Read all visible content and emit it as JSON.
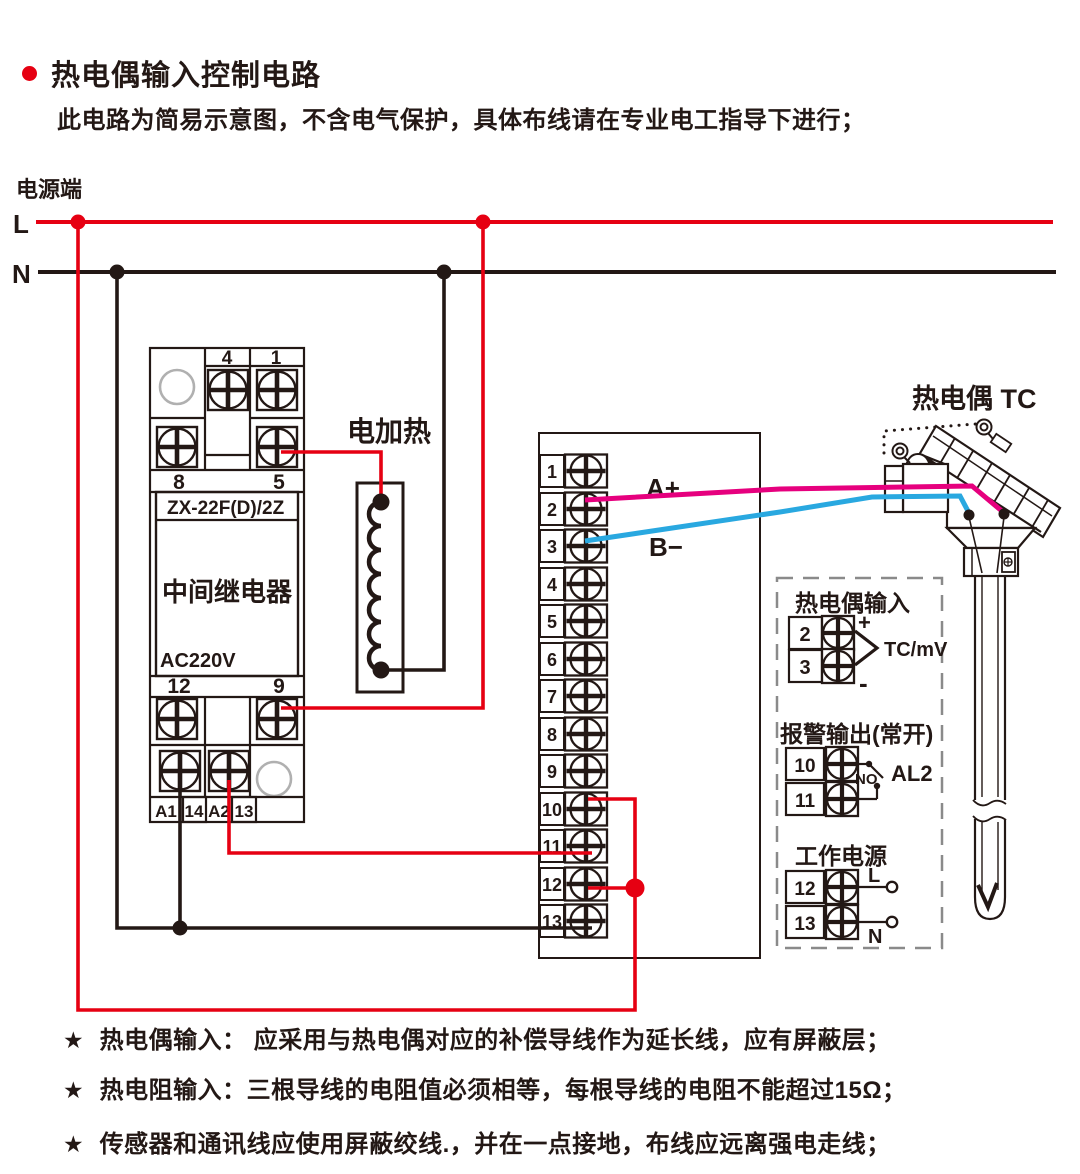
{
  "title": "热电偶输入控制电路",
  "subtitle": "此电路为简易示意图，不含电气保护，具体布线请在专业电工指导下进行；",
  "power": {
    "label": "电源端",
    "l": "L",
    "n": "N"
  },
  "relay": {
    "t4": "4",
    "t1": "1",
    "t8": "8",
    "t5": "5",
    "model": "ZX-22F(D)/2Z",
    "name": "中间继电器",
    "voltage": "AC220V",
    "t12": "12",
    "t9": "9",
    "a1": "A1",
    "t14": "14",
    "a2": "A2",
    "t13": "13"
  },
  "heater": {
    "label": "电加热"
  },
  "instrument": {
    "terminals": [
      "1",
      "2",
      "3",
      "4",
      "5",
      "6",
      "7",
      "8",
      "9",
      "10",
      "11",
      "12",
      "13"
    ],
    "wire_a": "A+",
    "wire_b": "B−"
  },
  "tc": {
    "label": "热电偶 TC"
  },
  "panel": {
    "tc_input": {
      "title": "热电偶输入",
      "t2": "2",
      "t3": "3",
      "plus": "+",
      "minus": "-",
      "signal": "TC/mV"
    },
    "alarm": {
      "title": "报警输出(常开)",
      "t10": "10",
      "t11": "11",
      "contact": "NO",
      "name": "AL2"
    },
    "supply": {
      "title": "工作电源",
      "t12": "12",
      "t13": "13",
      "l": "L",
      "n": "N"
    }
  },
  "note_marker": "★",
  "notes": [
    "热电偶输入： 应采用与热电偶对应的补偿导线作为延长线，应有屏蔽层；",
    "热电阻输入：三根导线的电阻值必须相等，每根导线的电阻不能超过15Ω；",
    "传感器和通讯线应使用屏蔽绞线.，并在一点接地，布线应远离强电走线；"
  ],
  "colors": {
    "live": "#e60012",
    "neutral": "#231815",
    "wire_a_pink": "#e6007e",
    "wire_b_blue": "#29a8e0",
    "panel_dash": "#8a8a8a"
  }
}
